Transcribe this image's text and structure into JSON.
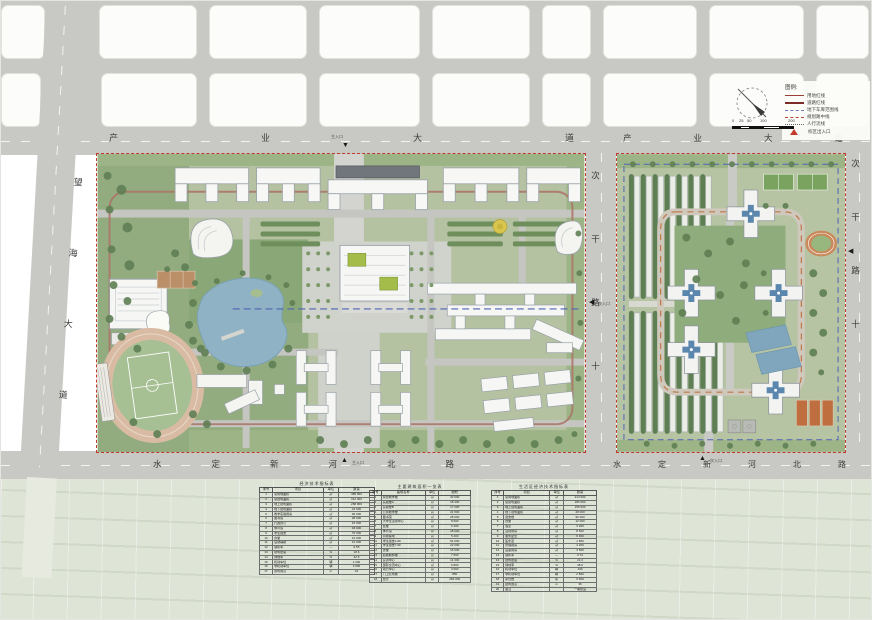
{
  "roads": {
    "top1": "产业大道",
    "top2": "产业大道",
    "bottom1": "水定新河北路",
    "bottom2": "水定新河北路",
    "left": "望海大道",
    "center": "次干路十",
    "right": "次干路十"
  },
  "entrances": {
    "main": "主入口",
    "side": "次入口"
  },
  "legend": {
    "title": "图例:",
    "items": [
      {
        "label": "用地红线"
      },
      {
        "label": "道路红线"
      },
      {
        "label": "地下车库范围线"
      },
      {
        "label": "规划路中线"
      },
      {
        "label": "人行流线"
      },
      {
        "label": "校区出入口"
      }
    ]
  },
  "scalebar": {
    "ticks": [
      "0",
      "25",
      "50",
      "100",
      "200"
    ]
  },
  "tables": {
    "t1": {
      "title": "经济技术指标表",
      "headers": [
        "序号",
        "项目",
        "单位",
        "数量"
      ],
      "rows": [
        [
          "1",
          "总用地面积",
          "㎡",
          "486 000"
        ],
        [
          "2",
          "总建筑面积",
          "㎡",
          "312 000"
        ],
        [
          "3",
          "地上建筑面积",
          "㎡",
          "268 000"
        ],
        [
          "4",
          "地下建筑面积",
          "㎡",
          "44 000"
        ],
        [
          "5",
          "教学实验用房",
          "㎡",
          "96 000"
        ],
        [
          "6",
          "图书馆",
          "㎡",
          "28 000"
        ],
        [
          "7",
          "行政办公",
          "㎡",
          "15 000"
        ],
        [
          "8",
          "体育馆",
          "㎡",
          "18 000"
        ],
        [
          "9",
          "学生宿舍",
          "㎡",
          "76 000"
        ],
        [
          "10",
          "食堂",
          "㎡",
          "16 000"
        ],
        [
          "11",
          "后勤辅助",
          "㎡",
          "12 000"
        ],
        [
          "12",
          "容积率",
          "—",
          "0.55"
        ],
        [
          "13",
          "建筑密度",
          "%",
          "18.6"
        ],
        [
          "14",
          "绿地率",
          "%",
          "42.5"
        ],
        [
          "15",
          "机动车位",
          "辆",
          "1 200"
        ],
        [
          "16",
          "非机动车位",
          "辆",
          "3 600"
        ],
        [
          "17",
          "建筑限高",
          "m",
          "24"
        ]
      ]
    },
    "t2": {
      "title": "主要建筑面积一览表",
      "headers": [
        "序号",
        "建筑名称",
        "单位",
        "面积"
      ],
      "rows": [
        [
          "1",
          "综合教学楼",
          "㎡",
          "32 600"
        ],
        [
          "2",
          "实验楼A",
          "㎡",
          "18 400"
        ],
        [
          "3",
          "实验楼B",
          "㎡",
          "17 200"
        ],
        [
          "4",
          "公共教学楼",
          "㎡",
          "21 500"
        ],
        [
          "5",
          "图书馆",
          "㎡",
          "28 000"
        ],
        [
          "6",
          "大学生活动中心",
          "㎡",
          "8 600"
        ],
        [
          "7",
          "会堂",
          "㎡",
          "6 400"
        ],
        [
          "8",
          "体育馆",
          "㎡",
          "18 000"
        ],
        [
          "9",
          "风雨操场",
          "㎡",
          "5 200"
        ],
        [
          "10",
          "学生宿舍1-6#",
          "㎡",
          "54 000"
        ],
        [
          "11",
          "学生宿舍7-9#",
          "㎡",
          "22 000"
        ],
        [
          "12",
          "食堂",
          "㎡",
          "16 000"
        ],
        [
          "13",
          "后勤服务楼",
          "㎡",
          "7 500"
        ],
        [
          "14",
          "实训中心",
          "㎡",
          "14 300"
        ],
        [
          "15",
          "国际交流中心",
          "㎡",
          "9 800"
        ],
        [
          "16",
          "动力中心",
          "㎡",
          "3 600"
        ],
        [
          "17",
          "门卫及附属",
          "㎡",
          "850"
        ],
        [
          "18",
          "合计",
          "㎡",
          "284 000"
        ]
      ]
    },
    "t3": {
      "title": "生活区经济技术指标表",
      "headers": [
        "序号",
        "项目",
        "单位",
        "数量"
      ],
      "rows": [
        [
          "1",
          "总用地面积",
          "㎡",
          "214 000"
        ],
        [
          "2",
          "总建筑面积",
          "㎡",
          "186 000"
        ],
        [
          "3",
          "地上建筑面积",
          "㎡",
          "158 000"
        ],
        [
          "4",
          "地下建筑面积",
          "㎡",
          "28 000"
        ],
        [
          "5",
          "宿舍楼",
          "㎡",
          "96 000"
        ],
        [
          "6",
          "食堂",
          "㎡",
          "12 000"
        ],
        [
          "7",
          "浴室",
          "㎡",
          "3 200"
        ],
        [
          "8",
          "活动用房",
          "㎡",
          "8 600"
        ],
        [
          "9",
          "服务配套",
          "㎡",
          "6 400"
        ],
        [
          "10",
          "医务室",
          "㎡",
          "1 800"
        ],
        [
          "11",
          "管理用房",
          "㎡",
          "4 200"
        ],
        [
          "12",
          "设备用房",
          "㎡",
          "3 500"
        ],
        [
          "13",
          "容积率",
          "—",
          "0.74"
        ],
        [
          "14",
          "建筑密度",
          "%",
          "21.3"
        ],
        [
          "15",
          "绿地率",
          "%",
          "38.6"
        ],
        [
          "16",
          "机动车位",
          "辆",
          "460"
        ],
        [
          "17",
          "非机动车位",
          "辆",
          "2 800"
        ],
        [
          "18",
          "床位数",
          "床",
          "9 600"
        ],
        [
          "19",
          "建筑限高",
          "m",
          "36"
        ],
        [
          "20",
          "备注",
          "",
          "一期建设"
        ]
      ]
    }
  }
}
